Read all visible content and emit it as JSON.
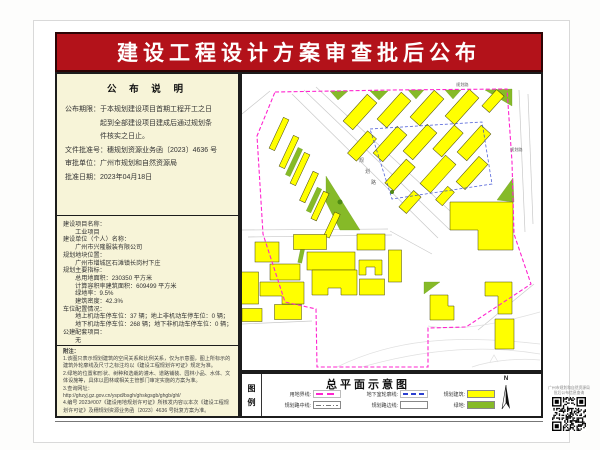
{
  "page": {
    "title": "建设工程设计方案审查批后公布"
  },
  "colors": {
    "banner_red": "#b3121a",
    "panel_cream": "#f7f4d8",
    "building_yellow": "#ffff00",
    "green": "#86ba28",
    "boundary_magenta": "#ff25cf",
    "underground_blue": "#2b3fd0"
  },
  "announcement": {
    "heading": "公 布 说 明",
    "lines": [
      "公布期限：于本规划建设项目首期工程开工之日",
      "　　　　　起到全部建设项目建成后通过规划条",
      "　　　　　件核实之日止。",
      "文件批准号：穗规划资源业务函〔2023〕4636 号",
      "审批单位：广州市规划和自然资源局",
      "批准日期：2023年04月18日"
    ]
  },
  "project": {
    "lines": [
      "建设项目名称：",
      "　　工业项目",
      "建设单位（个人）名称：",
      "　　广州市兴隆服装有限公司",
      "规划地块位置：",
      "　　广州市增城区石滩镇长岗村下庄",
      "规划主要指标：",
      "　　总用地面积：230350 平方米",
      "　　计算容积率建筑面积：609499 平方米",
      "　　绿地率：9.5%",
      "　　建筑密度：42.3%",
      "车位配置情况：",
      "　　地上机动车停车位：37 辆；地上非机动车停车位：0 辆；",
      "　　地下机动车停车位：268 辆；地下非机动车停车位：0 辆；",
      "公建配套项目：",
      "　　无"
    ]
  },
  "notes": {
    "heading": "附注：",
    "items": [
      "1.该图只表示规划建筑的空间关系和比例关系，仅为示意图，图上所标示的建筑外轮廓线及尺寸之标注均以《建设工程规划许可证》规定为准。",
      "2.绿地的位置和形状、树种和选栽的灌木、道路铺装、园林小品、水体、文体设施等，具体以园林或相关主管部门审定实施的方案为准。",
      "3.查询网址：",
      "http://ghzyj.gz.gov.cn/yspd/bsgh/ghskgsgb/ghgb/ghl/",
      "4.编号 2023#007《建设用地规划许可证》所核发内容以本次《建设工程规划许可证》及穗规划资源业务函〔2023〕4636 号批复方案为准。"
    ]
  },
  "legend": {
    "key_top": "图",
    "key_bottom": "例",
    "title": "总平面示意图",
    "north_label": "N",
    "items": [
      {
        "label": "用地界线:",
        "swatch": "magenta-dash"
      },
      {
        "label": "地下室轮廓线:",
        "swatch": "blue-dash"
      },
      {
        "label": "规划建筑:",
        "swatch": "yellow"
      },
      {
        "label": "规划路中线:",
        "swatch": "centerline"
      },
      {
        "label": "规划路边线:",
        "swatch": "white"
      },
      {
        "label": "绿地:",
        "swatch": "green"
      }
    ]
  },
  "qr": {
    "caption1": "广州市规划和自然资源局",
    "caption2": "批后公布信息查询"
  },
  "map": {
    "boundary": "33,18 150,16 265,15 270,88 272,160 289,210 224,253 186,254 186,293 75,293 74,235 43,228 21,160 15,62",
    "underground": "128,55 240,48 250,110 150,125",
    "roads": [
      "50,20 196,164",
      "62,16 208,156",
      "74,13 220,148",
      "0,156 146,155",
      "6,163 150,161",
      "148,157 190,180",
      "277,16 283,158",
      "286,20 291,150",
      "28,17 0,40",
      "292,210 236,256",
      "0,250 70,247"
    ],
    "contours": [
      "M95,293 C150,266 210,260 298,270",
      "M120,293 C180,276 240,270 298,280",
      "M186,252 C220,258 262,248 298,238",
      "M230,293 C250,286 280,284 298,286",
      "M248,288 l4,-7 l4,7"
    ],
    "greens_poly": [
      "88,17 106,17 96,26",
      "128,17 146,17 137,26",
      "166,16 182,16 174,25",
      "203,16 219,16 211,25",
      "243,16 270,15 270,32",
      "255,126 271,104 272,128",
      "84,102 118,156 98,156 84,128",
      "182,208 198,208 182,220"
    ],
    "greens_rot": [
      [
        52,
        88,
        5,
        30,
        25
      ],
      [
        72,
        126,
        5,
        26,
        25
      ],
      [
        60,
        178,
        4,
        22,
        12
      ]
    ],
    "buildings_rot": [
      [
        118,
        38,
        13,
        36,
        42
      ],
      [
        152,
        36,
        13,
        36,
        42
      ],
      [
        185,
        34,
        13,
        36,
        42
      ],
      [
        220,
        33,
        13,
        36,
        42
      ],
      [
        251,
        27,
        10,
        22,
        42
      ],
      [
        120,
        72,
        12,
        30,
        42
      ],
      [
        148,
        70,
        13,
        36,
        42
      ],
      [
        178,
        68,
        13,
        36,
        42
      ],
      [
        206,
        67,
        12,
        32,
        42
      ],
      [
        232,
        69,
        13,
        36,
        42
      ],
      [
        158,
        101,
        12,
        32,
        42
      ],
      [
        196,
        100,
        14,
        38,
        42
      ],
      [
        230,
        99,
        12,
        34,
        42
      ],
      [
        168,
        128,
        10,
        22,
        42
      ],
      [
        203,
        122,
        9,
        18,
        42
      ],
      [
        37,
        60,
        6,
        34,
        25
      ],
      [
        47,
        78,
        6,
        34,
        25
      ],
      [
        58,
        95,
        6,
        34,
        25
      ],
      [
        67,
        113,
        6,
        32,
        25
      ],
      [
        78,
        132,
        6,
        30,
        25
      ],
      [
        90,
        151,
        6,
        26,
        25
      ],
      [
        25,
        178,
        24,
        20,
        0
      ],
      [
        68,
        168,
        33,
        15,
        0
      ],
      [
        89,
        187,
        48,
        18,
        0
      ],
      [
        129,
        168,
        28,
        16,
        0
      ],
      [
        153,
        192,
        13,
        32,
        0
      ],
      [
        8,
        214,
        17,
        32,
        0
      ],
      [
        43,
        198,
        30,
        16,
        0
      ],
      [
        130,
        213,
        25,
        16,
        0
      ],
      [
        10,
        241,
        20,
        13,
        0
      ],
      [
        46,
        238,
        27,
        15,
        0
      ]
    ],
    "buildings_poly": [
      "117,186 140,186 140,201 133,201 133,193 124,193 124,201 117,201",
      "18,208 62,208 62,230 40,230 40,222 18,222",
      "70,196 115,196 115,221 99,221 99,214 86,214 86,221 70,221",
      "208,128 271,128 271,176 236,176 236,156 208,156",
      "243,208 270,208 270,240 256,240 256,222 243,222",
      "253,245 272,245 272,275 253,275",
      "188,221 206,221 206,232 212,232 212,246 188,246"
    ],
    "trees": [
      [
        98,
        128,
        2.5
      ],
      [
        150,
        118,
        2
      ]
    ],
    "labels": [
      {
        "text": "规划路",
        "x": 214,
        "y": 12,
        "size": 4.2,
        "vertical": false
      },
      {
        "text": "规划路",
        "x": 268,
        "y": 77,
        "size": 4.2,
        "vertical": false
      },
      {
        "text": "规划路",
        "x": 117,
        "y": 88,
        "size": 5,
        "vertical": true,
        "dx": 6,
        "dy": 11
      }
    ]
  }
}
